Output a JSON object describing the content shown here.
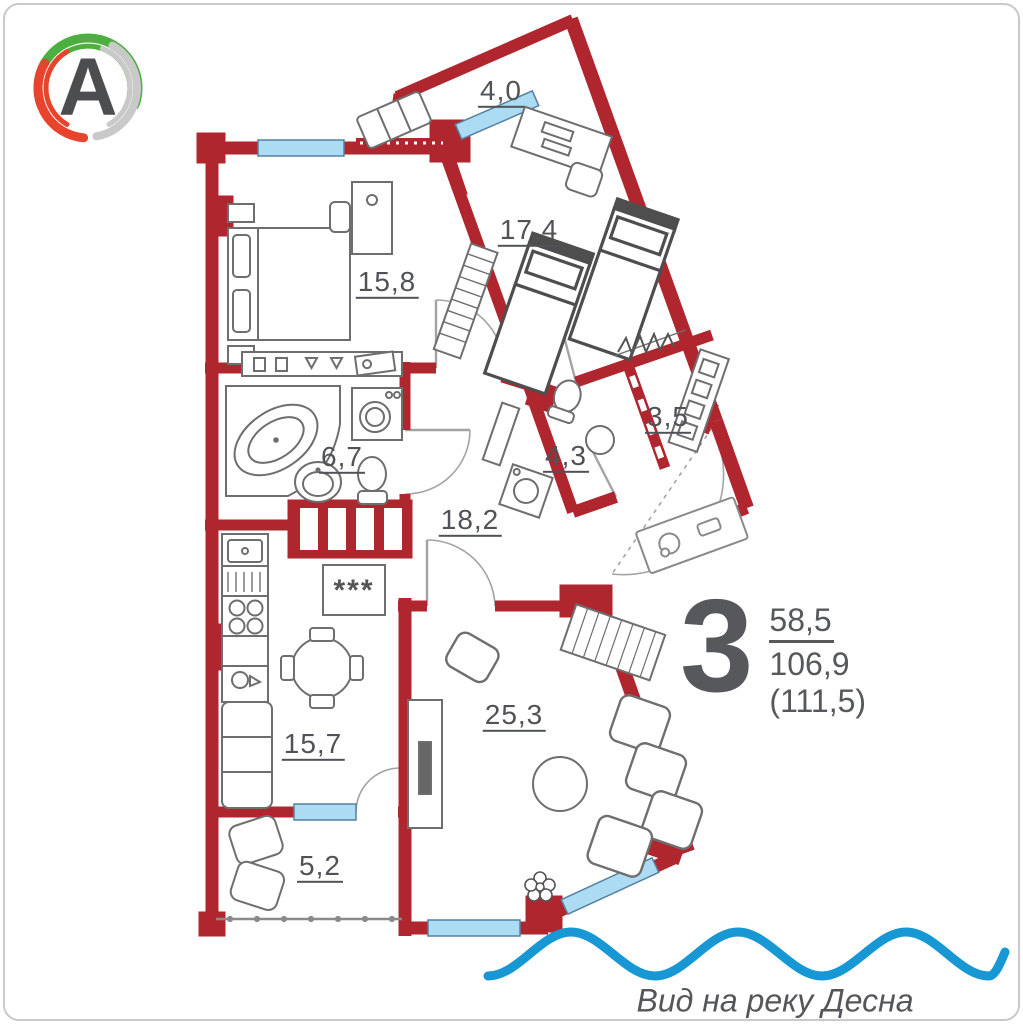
{
  "logo": {
    "letter": "A"
  },
  "plan": {
    "rooms": [
      {
        "name": "balcony-top",
        "label": "4,0"
      },
      {
        "name": "bedroom-2",
        "label": "17,4"
      },
      {
        "name": "bedroom-1",
        "label": "15,8"
      },
      {
        "name": "bathroom",
        "label": "6,7"
      },
      {
        "name": "shower-room",
        "label": "4,3"
      },
      {
        "name": "wardrobe",
        "label": "3,5"
      },
      {
        "name": "hallway",
        "label": "18,2"
      },
      {
        "name": "kitchen-living",
        "label": "15,7"
      },
      {
        "name": "living-room",
        "label": "25,3"
      },
      {
        "name": "balcony-bottom",
        "label": "5,2"
      }
    ],
    "stove_symbol": "***"
  },
  "stats": {
    "rooms_count": "3",
    "living_area": "58,5",
    "total_area": "106,9",
    "full_area": "(111,5)"
  },
  "footer": {
    "view_caption": "Вид на реку Десна"
  },
  "icons": {
    "logo_ring": "swirl-ring",
    "water": "wave-line"
  },
  "colors": {
    "wall": "#b0262f",
    "window_fill": "#abdcf4",
    "wave": "#1798d5",
    "text_gray": "#57585c",
    "logo_green": "#4caf3f",
    "logo_red": "#e8432d",
    "logo_gray": "#c9c9ca"
  }
}
